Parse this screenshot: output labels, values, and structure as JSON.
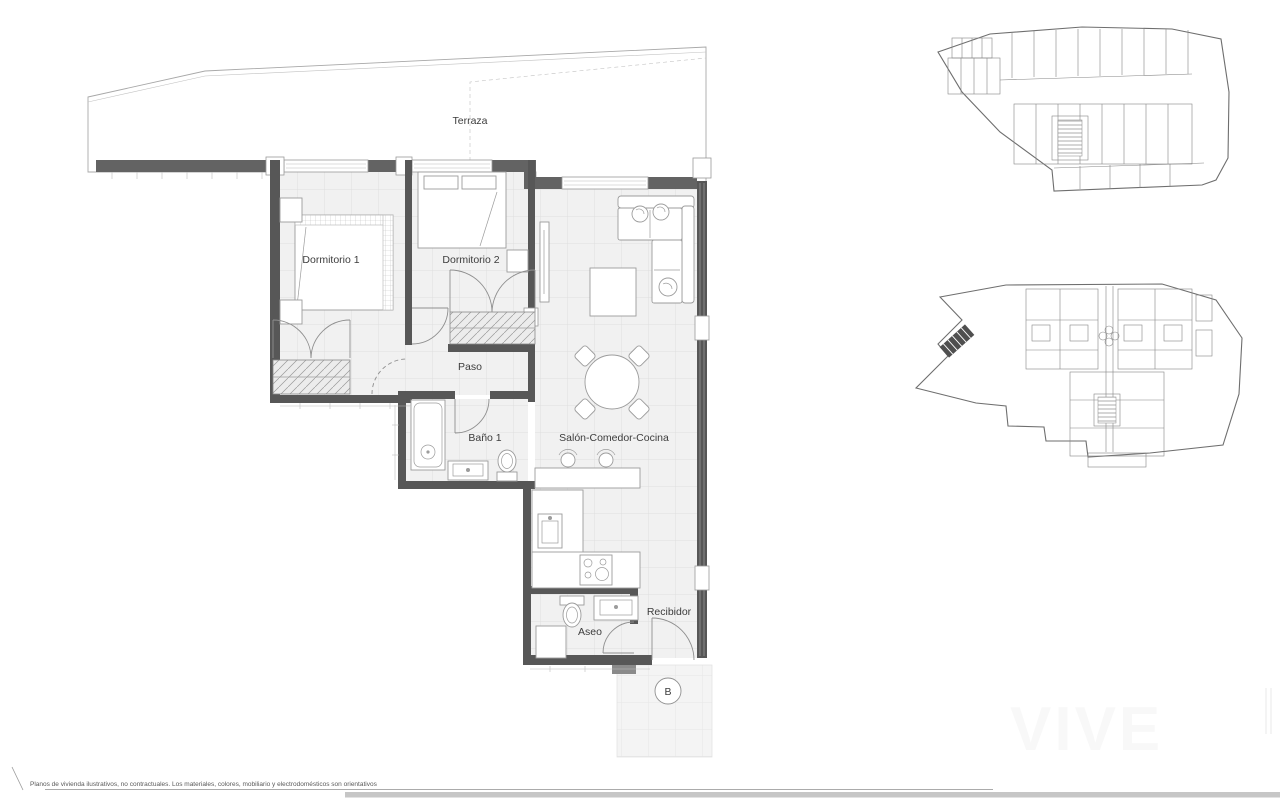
{
  "labels": {
    "terraza": "Terraza",
    "dormitorio1": "Dormitorio 1",
    "dormitorio2": "Dormitorio 2",
    "paso": "Paso",
    "bano1": "Baño 1",
    "salon": "Salón-Comedor-Cocina",
    "aseo": "Aseo",
    "recibidor": "Recibidor",
    "portal": "B"
  },
  "footer": {
    "disclaimer": "Planos de vivienda ilustrativos, no contractuales. Los materiales, colores, mobiliario y electrodomésticos son orientativos"
  },
  "watermark": {
    "text": "VIVE"
  },
  "colors": {
    "wall": "#575757",
    "band": "#636363",
    "floor": "#f1f1f1",
    "grid": "#dddddd",
    "line": "#9a9a9a",
    "furniture": "#9c9c9c",
    "text": "#3c3c3c",
    "hatch_fill": "#ececec"
  }
}
